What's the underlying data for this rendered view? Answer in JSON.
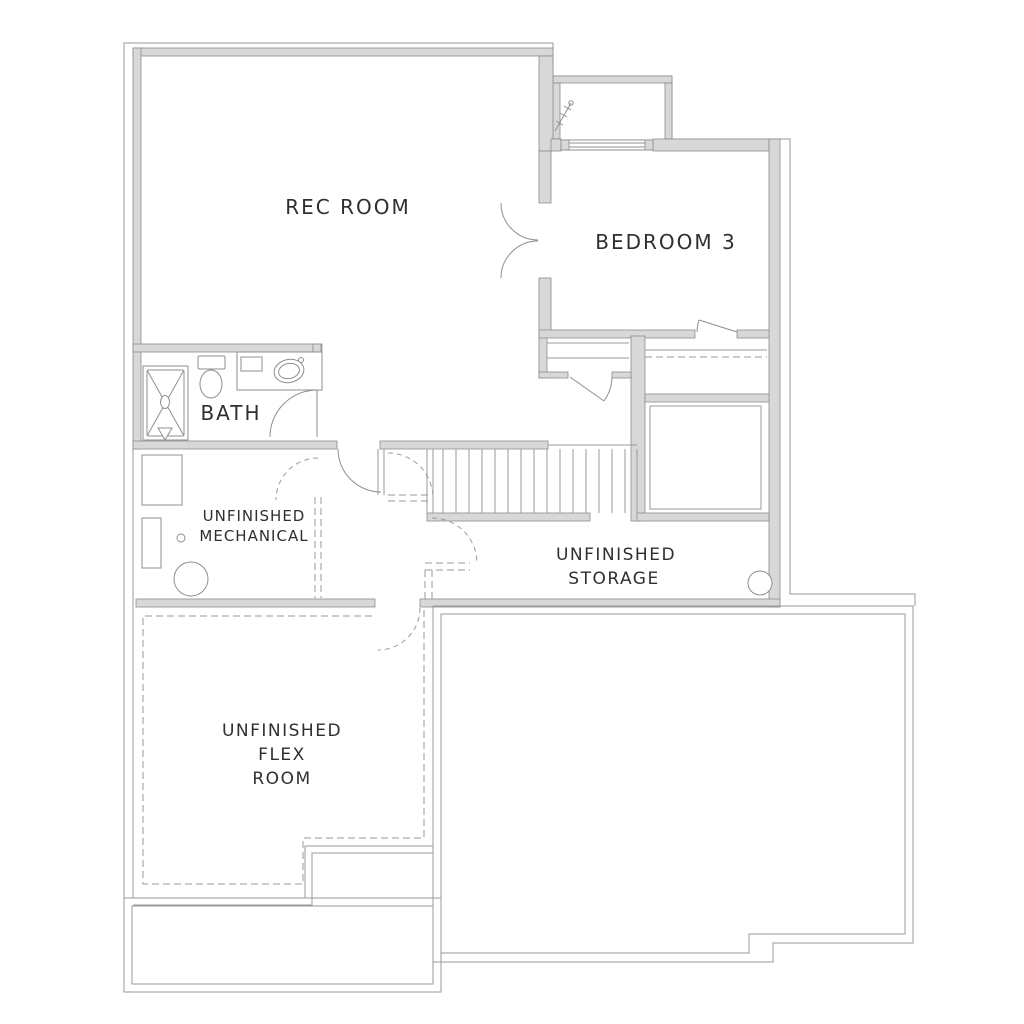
{
  "title": "Basement Floor Plan",
  "colors": {
    "background": "#ffffff",
    "wall_fill": "#d8d8d8",
    "wall_stroke": "#8c8c8c",
    "line": "#9a9a9a",
    "text": "#2f2f2f"
  },
  "rooms": {
    "rec_room": {
      "label": "REC ROOM"
    },
    "bedroom3": {
      "label": "BEDROOM 3"
    },
    "bath": {
      "label": "BATH"
    },
    "mechanical": {
      "line1": "UNFINISHED",
      "line2": "MECHANICAL"
    },
    "storage": {
      "line1": "UNFINISHED",
      "line2": "STORAGE"
    },
    "flex": {
      "line1": "UNFINISHED",
      "line2": "FLEX",
      "line3": "ROOM"
    }
  },
  "fixtures": [
    "shower",
    "toilet",
    "vanity-sink",
    "furnace",
    "water-softener",
    "floor-drain",
    "water-heater",
    "support-column",
    "egress-window",
    "window-well-ladder",
    "stairs"
  ]
}
